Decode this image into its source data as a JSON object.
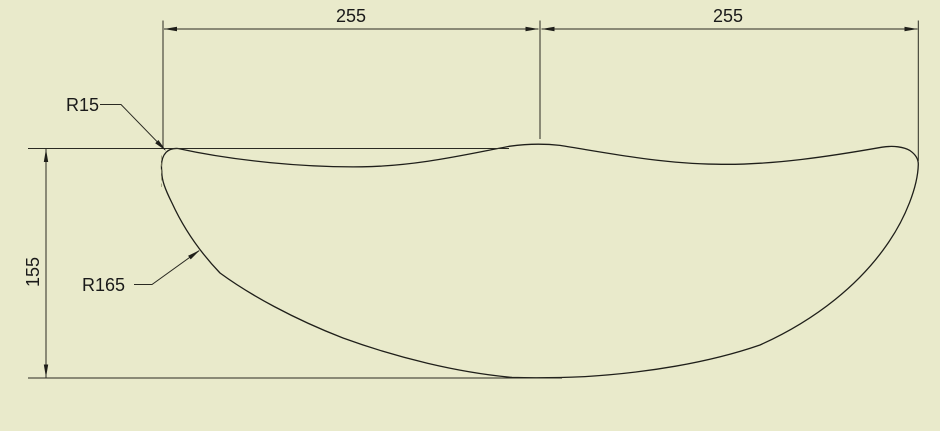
{
  "drawing": {
    "background_color": "#e9eacb",
    "line_color": "#1f1f1a",
    "dimensions": {
      "top_left_width": "255",
      "top_right_width": "255",
      "left_height": "155"
    },
    "callouts": {
      "fillet_radius": "R15",
      "profile_radius": "R165"
    }
  }
}
